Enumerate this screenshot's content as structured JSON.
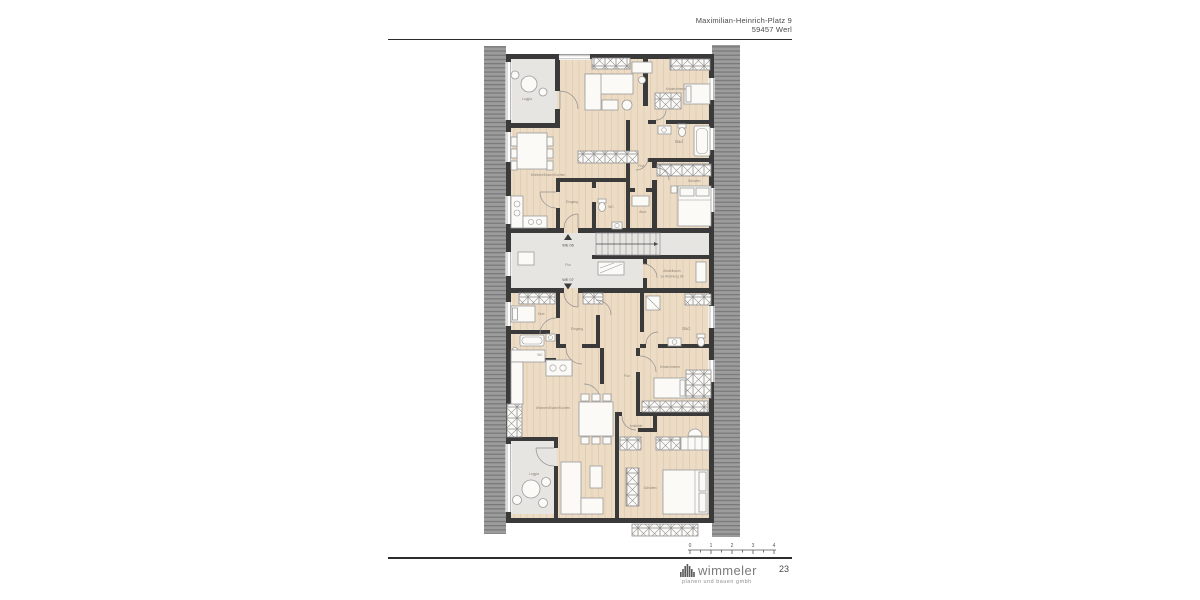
{
  "header": {
    "address_line1": "Maximilian-Heinrich-Platz 9",
    "address_line2": "59457 Werl"
  },
  "plan": {
    "colors": {
      "wall": "#3a3a3a",
      "wood_floor": "#eddcc5",
      "grey_floor": "#e6e5e1",
      "roof_hatch": "#9c9c9c"
    },
    "labels": {
      "u_loggia": "Loggia",
      "u_wohnen": "Wohnen/Essen/Kochen",
      "u_eingang": "Eingang",
      "u_wc": "WC",
      "u_flur": "Flur",
      "u_abst": "Abst.",
      "u_kinderzimmer": "Kinderzimmer",
      "u_bad": "Bad",
      "u_schlafen": "Schlafen",
      "hall_we06": "WE 06",
      "hall_flur": "Flur",
      "hall_we07": "WE 07",
      "abstellraum_line1": "Abstellraum",
      "abstellraum_line2": "zu Wohnung 06",
      "l_kind": "Kind",
      "l_wc": "WC",
      "l_eingang": "Eingang",
      "l_bad": "Bad",
      "l_flur": "Flur",
      "l_kinderzimmer": "Kinderzimmer",
      "l_wohnen": "Wohnen/Essen/Kochen",
      "l_ankleide": "Ankleide",
      "l_schlafen": "Schlafen",
      "l_loggia": "Loggia"
    }
  },
  "scale_bar": {
    "ticks": [
      "0",
      "1",
      "2",
      "3",
      "4"
    ]
  },
  "footer": {
    "brand": "wimmeler",
    "brand_sub": "planen und bauen gmbh",
    "page_number": "23"
  }
}
